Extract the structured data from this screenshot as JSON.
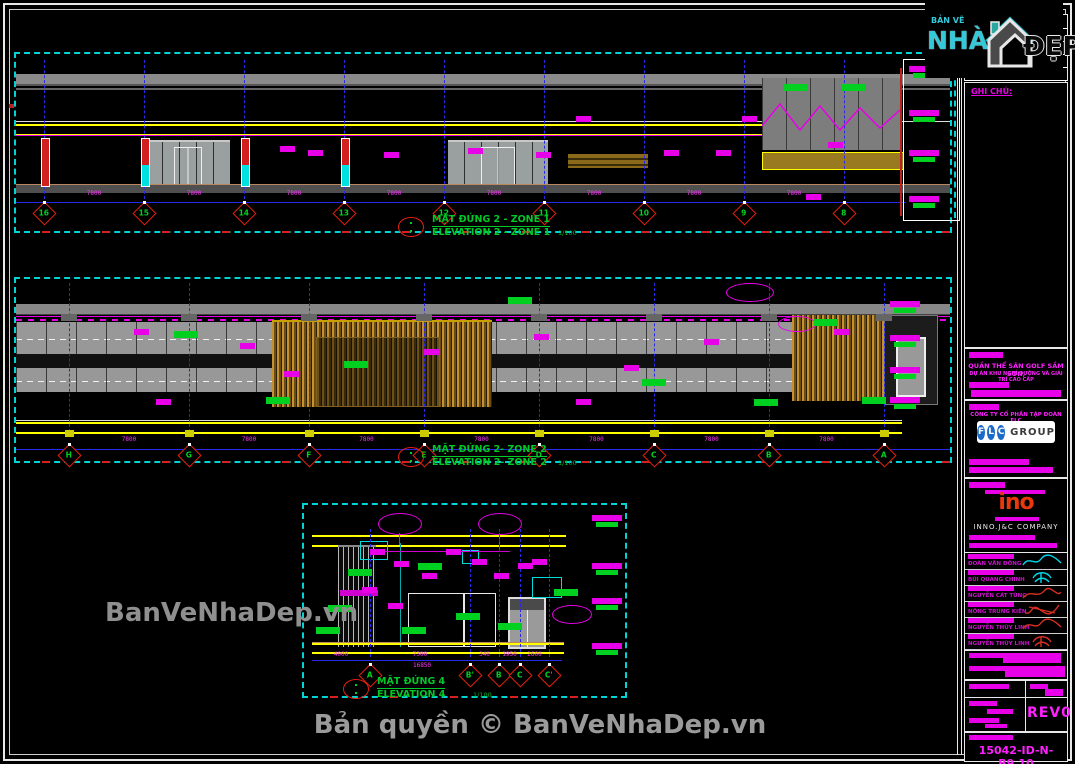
{
  "branding": {
    "logo_top": "BẢN VẼ",
    "logo_nha": "NHÀ",
    "logo_dep": "ĐẸP",
    "watermark_side": "BanVeNhaDep.vn",
    "watermark_bottom": "Bản quyền © BanVeNhaDep.vn"
  },
  "elevations": [
    {
      "title_vi": "MẶT ĐỨNG 2 - ZONE 1",
      "title_en": "ELEVATION 2 - ZONE 1",
      "scale": "1/100",
      "bubbles": [
        "16",
        "15",
        "14",
        "13",
        "12",
        "11",
        "10",
        "9",
        "8"
      ],
      "dims": [
        "7800",
        "7800",
        "7800",
        "7800",
        "7800",
        "7800",
        "7800",
        "7800"
      ]
    },
    {
      "title_vi": "MẶT ĐỨNG 2- ZONE 2",
      "title_en": "ELEVATION 2- ZONE 2",
      "scale": "1/100",
      "bubbles": [
        "H",
        "G",
        "F",
        "E",
        "D",
        "C",
        "B",
        "A"
      ],
      "dims": [
        "7800",
        "7800",
        "7800",
        "7800",
        "7800",
        "7800",
        "7800"
      ]
    },
    {
      "title_vi": "MẶT ĐỨNG 4",
      "title_en": "ELEVATION 4",
      "scale": "1/100",
      "bubbles": [
        "A",
        "B'",
        "B",
        "C",
        "C'"
      ],
      "dims": [
        "4000",
        "7300",
        "340",
        "1950",
        "2600"
      ],
      "dim_total": "16850"
    }
  ],
  "titleblock": {
    "notes_label": "GHI CHÚ:",
    "project_line1": "QUẦN THỂ SÂN GOLF SẦM SƠN,",
    "project_line2": "DỰ ÁN KHU NGHỈ DƯỠNG VÀ GIẢI TRÍ CAO CẤP",
    "client_name": "CÔNG TY CỔ PHẦN TẬP ĐOÀN FLC",
    "flc_letters": [
      "F",
      "L",
      "C"
    ],
    "flc_group": "GROUP",
    "designer_logo": "ino",
    "designer_name": "INNO.J&C COMPANY",
    "staff": [
      {
        "name": "ĐOÀN VĂN ĐÔNG",
        "sig": "cyan"
      },
      {
        "name": "BÙI QUANG CHINH",
        "sig": "cyan"
      },
      {
        "name": "NGUYỄN CÁT TÙNG",
        "sig": "red"
      },
      {
        "name": "NÔNG TRUNG KIÊN",
        "sig": "red"
      },
      {
        "name": "NGUYỄN THÙY LINH",
        "sig": "red"
      },
      {
        "name": "NGUYỄN THÙY LINH",
        "sig": "red"
      }
    ],
    "revision": "REV0",
    "drawing_number": "15042-ID-N-B9.10"
  },
  "colors": {
    "accent_cyan": "#00dcdc",
    "accent_magenta": "#ff00ff",
    "accent_yellow": "#ffff00",
    "accent_green": "#00d020",
    "grid_blue": "#2828e8",
    "alert_red": "#e82010"
  }
}
